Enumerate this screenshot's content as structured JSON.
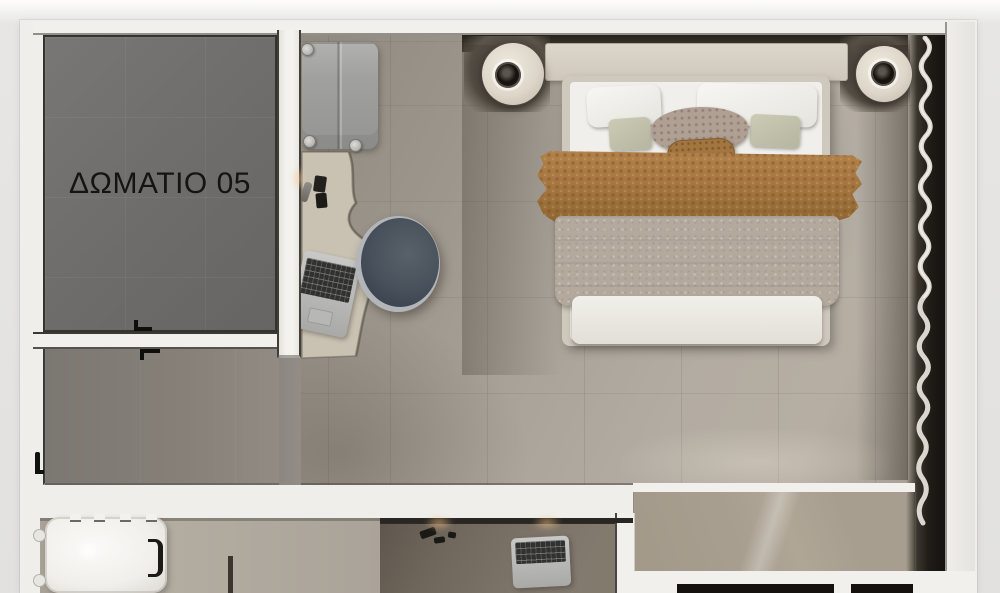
{
  "floorplan": {
    "room_label": "ΔΩΜΑΤΙΟ 05"
  },
  "palette": {
    "outer_background": "#e2e1df",
    "wall": "#f1f0ec",
    "room05_floor": "#6f6e6c",
    "main_floor": "#aaa399",
    "corridor_floor": "#847f7a",
    "window_band": "#201c16",
    "curtain": "#eae6dd",
    "headboard": "#d5cec2",
    "mattress": "#f0efeb",
    "pillow_white": "#f5f4f1",
    "cushion_sage": "#c5c5b0",
    "throw_caramel": "#a1733c",
    "duvet_taupe": "#b3a99d",
    "chair": "#49525c",
    "desk": "#c9c2b2",
    "suitcase": "#a0a09e",
    "lamp_disc": "#ddd6c9",
    "tan_panel": "#a89f90",
    "lower_desk": "#7b7267",
    "appliance": "#f1efeb",
    "label_text": "#141414"
  }
}
